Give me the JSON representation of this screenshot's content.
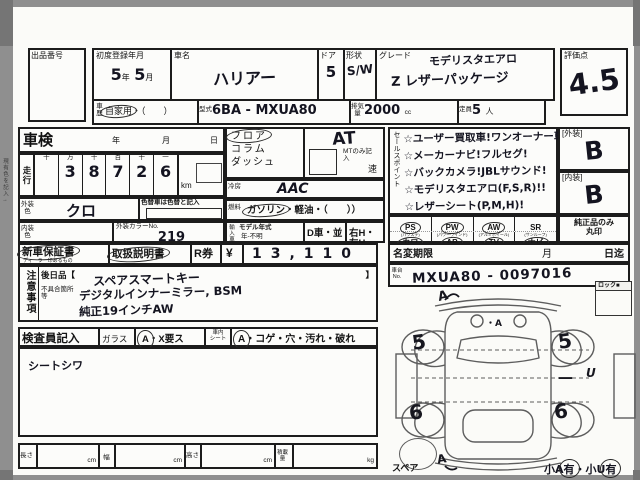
{
  "margin": {
    "side_note": "現有色を記入→"
  },
  "header": {
    "auction_no_label": "出品番号",
    "first_reg": {
      "label": "初度登録年月",
      "year": "5",
      "year_unit": "年",
      "month": "5",
      "month_unit": "月"
    },
    "car_name": {
      "label": "車名",
      "value": "ハリアー"
    },
    "door": {
      "label": "ドア",
      "value": "5"
    },
    "shape": {
      "label": "形状",
      "value": "S/W"
    },
    "grade": {
      "label": "グレード",
      "line1": "モデリスタエアロ",
      "line2": "Z レザーパッケージ"
    },
    "score": {
      "label": "評価点",
      "value": "4.5"
    },
    "history": {
      "label": "車歴",
      "selected": "自家用",
      "rest": "・（　　）",
      "circled": true
    },
    "model_code": {
      "label": "型式",
      "value": "6BA - MXUA80"
    },
    "displacement": {
      "label": "排気量",
      "value": "2000",
      "unit": "cc"
    },
    "capacity": {
      "label": "定員",
      "value": "5",
      "unit": "人"
    }
  },
  "inspection": {
    "shaken": {
      "label": "車検",
      "year_unit": "年",
      "month_unit": "月",
      "day_unit": "日"
    },
    "mileage": {
      "label": "走行",
      "col_headers": [
        "十",
        "万",
        "千",
        "百",
        "十",
        "一"
      ],
      "digits": [
        "",
        "3",
        "8",
        "7",
        "2",
        "6"
      ],
      "unit": "km"
    },
    "color_change_note": "色替車は色替と記入",
    "ext_color": {
      "label": "外装色",
      "value": "クロ"
    },
    "int_color": {
      "label": "内装色",
      "value": ""
    },
    "color_no": {
      "label": "外装カラーNo.",
      "value": "219"
    },
    "import_car": {
      "label": "輸入車",
      "model_year_label": "モデル年式",
      "value": "年-不明"
    },
    "d_car": "D車・並",
    "handle": "右H・左H",
    "position": {
      "opt1": "フロア",
      "opt2": "コラム",
      "opt3": "ダッシュ",
      "circled": true
    },
    "transmission": {
      "value": "AT",
      "mt_note": "MTのみ記入",
      "speed_unit": "速"
    },
    "ac": {
      "label": "冷房",
      "value": "AAC"
    },
    "fuel": {
      "label": "燃料",
      "selected": "ガソリン",
      "rest": "・軽油・（　　）",
      "circled": true
    },
    "warranty": {
      "label": "新車保証書",
      "sub": "ディーラー印あるもの",
      "circled": true
    },
    "manual": {
      "label": "取扱説明書",
      "circled": true
    },
    "r_ticket": {
      "label": "R券",
      "currency": "¥",
      "value": "13,110"
    }
  },
  "notes": {
    "label": "注意事項",
    "later_item": {
      "label": "後日品【",
      "value": "スペアスマートキー",
      "close": "】"
    },
    "defects": {
      "label": "不具合箇所等",
      "line1": "デジタルインナーミラー, BSM",
      "line2": "純正19インチAW"
    }
  },
  "inspector": {
    "label": "検査員記入",
    "glass_label": "ガラス",
    "glass_mark_a": "A",
    "glass_mark_rest": "・X要ス",
    "glass_circled": true,
    "seat_label_top": "車内",
    "seat_label_bottom": "シート",
    "seat_mark_a": "A",
    "seat_mark_rest": "・コゲ・穴・汚れ・破れ",
    "seat_circled": true,
    "handwritten_note": "シートシワ"
  },
  "sales": {
    "label": "セールスポイント",
    "lines": [
      "☆ユーザー買取車!ワンオーナー車!",
      "☆メーカーナビ!フルセグ!",
      "☆バックカメラ!JBLサウンド!",
      "☆モデリスタエアロ(F,S,R)!!",
      "☆レザーシート(P,M,H)!"
    ]
  },
  "ratings": {
    "exterior": {
      "label": "[外装]",
      "value": "B"
    },
    "interior": {
      "label": "[内装]",
      "value": "B"
    },
    "genuine_line1": "純正品のみ",
    "genuine_line2": "丸印"
  },
  "equipment": {
    "items": [
      {
        "label": "PS",
        "sub": "(パワステ)",
        "circled": true
      },
      {
        "label": "PW",
        "sub": "(パワーウインド)",
        "circled": true
      },
      {
        "label": "AW",
        "sub": "(アルミホイール)",
        "circled": true
      },
      {
        "label": "SR",
        "sub": "(サンルーフ)",
        "circled": false
      },
      {
        "label": "カワ",
        "sub": "(カワシート)",
        "circled": true
      },
      {
        "label": "AB",
        "sub": "(エアバッグ)",
        "circled": true
      },
      {
        "label": "TV",
        "sub": "(純正)",
        "circled": true
      },
      {
        "label": "ナビ",
        "sub": "(ナビゲーション)",
        "circled": true
      }
    ]
  },
  "name_change": {
    "label": "名変期限",
    "month_unit": "月",
    "deadline_unit": "日迄"
  },
  "chassis": {
    "label": "車台No.",
    "value": "MXUA80 - 0097016"
  },
  "diagram": {
    "lock_label": "ロック■",
    "spare_label": "スペア",
    "marks": {
      "front": "A",
      "hood": "・A",
      "rear": "A",
      "wheel_fl": "5",
      "wheel_fr": "5",
      "wheel_rl": "6",
      "wheel_rr": "6",
      "side_line": "—",
      "side_letter": "U"
    },
    "note_part1": "小A",
    "note_part2": "有",
    "note_part3": "・小U",
    "note_part4": "有",
    "note_circled": true
  },
  "footer": {
    "length_label": "長さ",
    "width_label": "幅",
    "height_label": "高さ",
    "load_label": "積載量",
    "cm": "cm",
    "kg": "kg"
  }
}
